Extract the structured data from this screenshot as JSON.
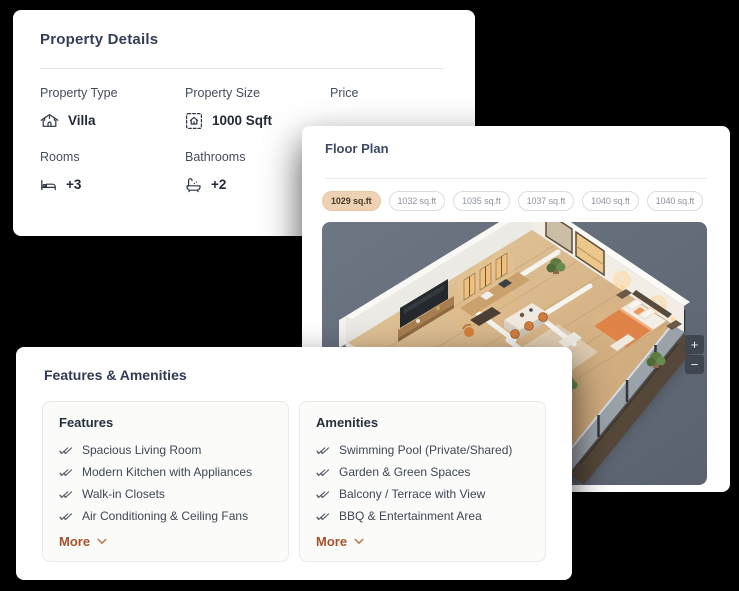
{
  "property_details": {
    "title": "Property Details",
    "labels": {
      "type": "Property Type",
      "size": "Property Size",
      "price": "Price",
      "rooms": "Rooms",
      "bathrooms": "Bathrooms"
    },
    "values": {
      "type": "Villa",
      "size": "1000 Sqft",
      "rooms": "+3",
      "bathrooms": "+2"
    }
  },
  "floor_plan": {
    "title": "Floor Plan",
    "tabs": [
      {
        "label": "1029 sq.ft",
        "selected": true
      },
      {
        "label": "1032 sq.ft",
        "selected": false
      },
      {
        "label": "1035 sq.ft",
        "selected": false
      },
      {
        "label": "1037 sq.ft",
        "selected": false
      },
      {
        "label": "1040 sq.ft",
        "selected": false
      },
      {
        "label": "1040 sq.ft",
        "selected": false
      }
    ],
    "zoom_in": "+",
    "zoom_out": "−"
  },
  "features_amenities": {
    "title": "Features & Amenities",
    "features": {
      "title": "Features",
      "items": [
        "Spacious Living Room",
        "Modern Kitchen with Appliances",
        "Walk-in Closets",
        "Air Conditioning & Ceiling Fans"
      ],
      "more": "More"
    },
    "amenities": {
      "title": "Amenities",
      "items": [
        "Swimming Pool (Private/Shared)",
        "Garden & Green Spaces",
        "Balcony / Terrace with View",
        "BBQ & Entertainment Area"
      ],
      "more": "More"
    }
  },
  "colors": {
    "selected_tab_bg": "#EDD2B4",
    "more_link": "#A5532C",
    "title_navy": "#2F3B55",
    "floorplan_backdrop": "#67707C",
    "page_background": "#000000"
  }
}
